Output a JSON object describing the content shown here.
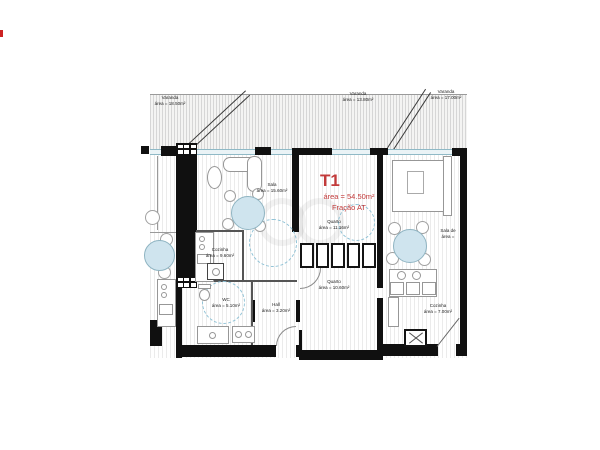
{
  "unit_label": {
    "code": "T1",
    "area": "área = 54.50m²",
    "fraction": "Fração AT",
    "color": "#c23a3a"
  },
  "rooms": {
    "varanda_left": {
      "name": "Varanda",
      "area": "área = 18.50m²"
    },
    "varanda_mid": {
      "name": "Varanda",
      "area": "área = 13.80m²"
    },
    "varanda_right": {
      "name": "Varanda",
      "area": "área = 17.00m²"
    },
    "sala": {
      "name": "Sala",
      "area": "área = 15.60m²"
    },
    "cozinha": {
      "name": "Cozinha",
      "area": "área = 9.60m²"
    },
    "wc": {
      "name": "WC",
      "area": "área = 5.10m²"
    },
    "hall": {
      "name": "Hall",
      "area": "área = 3.20m²"
    },
    "quarto_top": {
      "name": "Quarto",
      "area": "área = 11.16m²"
    },
    "quarto_bottom": {
      "name": "Quarto",
      "area": "área = 10.60m²"
    },
    "sala_right": {
      "name": "Sala de",
      "area": "área ="
    },
    "cozinha_right": {
      "name": "Cozinha",
      "area": "área = 7.00m²"
    }
  },
  "colors": {
    "wall": "#101010",
    "window_teal": "#8fb9c6",
    "table_blue": "#cfe4ee",
    "turning_circle_blue": "#8fc2d6",
    "unit_label_red": "#c23a3a",
    "corner_mark_red": "#cc2222"
  }
}
